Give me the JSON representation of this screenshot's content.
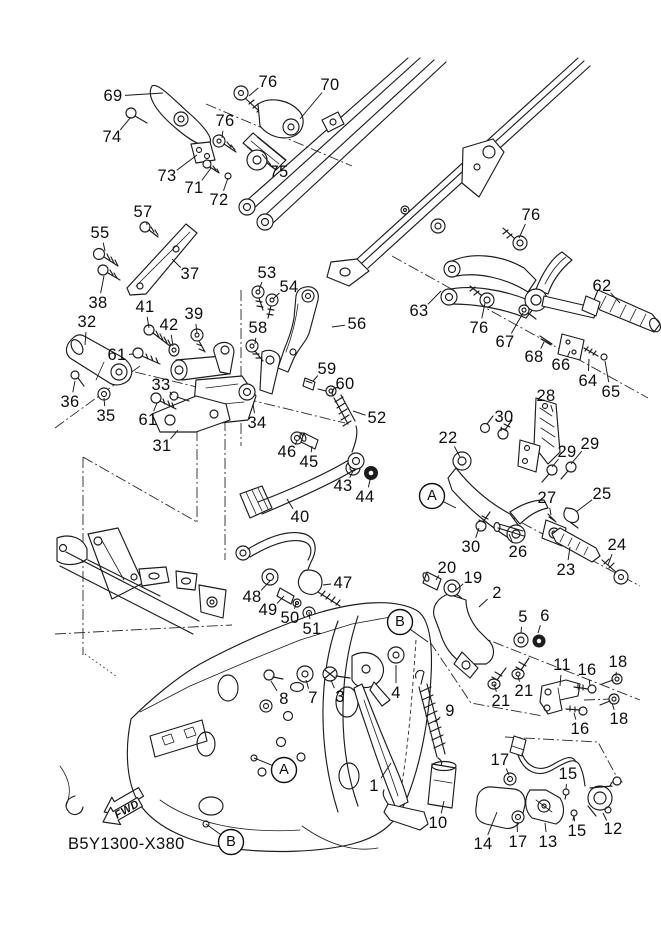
{
  "meta": {
    "drawing_code": "B5Y1300-X380",
    "fwd_label": "FWD",
    "background": "#ffffff",
    "line_color": "#1c1c1c",
    "description": "Exploded parts diagram - stand / footrest"
  },
  "callouts": [
    {
      "n": "69",
      "x": 113,
      "y": 96,
      "tx": 163,
      "ty": 93
    },
    {
      "n": "76",
      "x": 268,
      "y": 82,
      "tx": 249,
      "ty": 96
    },
    {
      "n": "70",
      "x": 330,
      "y": 85,
      "tx": 300,
      "ty": 119
    },
    {
      "n": "74",
      "x": 112,
      "y": 137,
      "tx": 131,
      "ty": 117
    },
    {
      "n": "76",
      "x": 225,
      "y": 121,
      "tx": 222,
      "ty": 138
    },
    {
      "n": "73",
      "x": 167,
      "y": 176,
      "tx": 197,
      "ty": 155
    },
    {
      "n": "71",
      "x": 194,
      "y": 188,
      "tx": 211,
      "ty": 168
    },
    {
      "n": "72",
      "x": 219,
      "y": 200,
      "tx": 228,
      "ty": 178
    },
    {
      "n": "75",
      "x": 279,
      "y": 172,
      "tx": 262,
      "ty": 154
    },
    {
      "n": "76",
      "x": 531,
      "y": 215,
      "tx": 519,
      "ty": 238
    },
    {
      "n": "57",
      "x": 143,
      "y": 212,
      "tx": 147,
      "ty": 225
    },
    {
      "n": "55",
      "x": 100,
      "y": 233,
      "tx": 105,
      "ty": 251
    },
    {
      "n": "38",
      "x": 98,
      "y": 303,
      "tx": 104,
      "ty": 276
    },
    {
      "n": "37",
      "x": 190,
      "y": 274,
      "tx": 172,
      "ty": 259
    },
    {
      "n": "53",
      "x": 267,
      "y": 273,
      "tx": 259,
      "ty": 290
    },
    {
      "n": "54",
      "x": 289,
      "y": 287,
      "tx": 273,
      "ty": 299
    },
    {
      "n": "62",
      "x": 602,
      "y": 286,
      "tx": 620,
      "ty": 303
    },
    {
      "n": "63",
      "x": 419,
      "y": 311,
      "tx": 441,
      "ty": 291
    },
    {
      "n": "32",
      "x": 87,
      "y": 322,
      "tx": 85,
      "ty": 345
    },
    {
      "n": "41",
      "x": 145,
      "y": 307,
      "tx": 149,
      "ty": 328
    },
    {
      "n": "42",
      "x": 169,
      "y": 325,
      "tx": 173,
      "ty": 346
    },
    {
      "n": "39",
      "x": 194,
      "y": 314,
      "tx": 197,
      "ty": 333
    },
    {
      "n": "58",
      "x": 258,
      "y": 328,
      "tx": 255,
      "ty": 344
    },
    {
      "n": "56",
      "x": 357,
      "y": 324,
      "tx": 332,
      "ty": 327
    },
    {
      "n": "76",
      "x": 479,
      "y": 328,
      "tx": 485,
      "ty": 303
    },
    {
      "n": "67",
      "x": 505,
      "y": 342,
      "tx": 523,
      "ty": 313
    },
    {
      "n": "68",
      "x": 534,
      "y": 357,
      "tx": 544,
      "ty": 342
    },
    {
      "n": "66",
      "x": 561,
      "y": 365,
      "tx": 570,
      "ty": 351
    },
    {
      "n": "61",
      "x": 117,
      "y": 355,
      "tx": 133,
      "ty": 354
    },
    {
      "n": "59",
      "x": 327,
      "y": 369,
      "tx": 313,
      "ty": 381
    },
    {
      "n": "64",
      "x": 588,
      "y": 381,
      "tx": 589,
      "ty": 359
    },
    {
      "n": "60",
      "x": 345,
      "y": 384,
      "tx": 333,
      "ty": 390
    },
    {
      "n": "65",
      "x": 611,
      "y": 392,
      "tx": 605,
      "ty": 361
    },
    {
      "n": "36",
      "x": 70,
      "y": 402,
      "tx": 75,
      "ty": 381
    },
    {
      "n": "33",
      "x": 161,
      "y": 385,
      "tx": 172,
      "ty": 395
    },
    {
      "n": "35",
      "x": 106,
      "y": 416,
      "tx": 104,
      "ty": 398
    },
    {
      "n": "61",
      "x": 148,
      "y": 420,
      "tx": 157,
      "ty": 403
    },
    {
      "n": "34",
      "x": 257,
      "y": 423,
      "tx": 253,
      "ty": 404
    },
    {
      "n": "52",
      "x": 377,
      "y": 418,
      "tx": 353,
      "ty": 411
    },
    {
      "n": "28",
      "x": 546,
      "y": 396,
      "tx": 553,
      "ty": 412
    },
    {
      "n": "30",
      "x": 504,
      "y": 417,
      "tx": 501,
      "ty": 431
    },
    {
      "n": "22",
      "x": 448,
      "y": 438,
      "tx": 460,
      "ty": 457
    },
    {
      "n": "29",
      "x": 567,
      "y": 452,
      "tx": 552,
      "ty": 467
    },
    {
      "n": "29",
      "x": 590,
      "y": 444,
      "tx": 571,
      "ty": 464
    },
    {
      "n": "31",
      "x": 162,
      "y": 446,
      "tx": 178,
      "ty": 430
    },
    {
      "n": "46",
      "x": 287,
      "y": 452,
      "tx": 297,
      "ty": 441
    },
    {
      "n": "45",
      "x": 309,
      "y": 462,
      "tx": 312,
      "ty": 446
    },
    {
      "n": "43",
      "x": 343,
      "y": 486,
      "tx": 353,
      "ty": 471
    },
    {
      "n": "44",
      "x": 365,
      "y": 497,
      "tx": 371,
      "ty": 476
    },
    {
      "n": "27",
      "x": 547,
      "y": 498,
      "tx": 551,
      "ty": 515
    },
    {
      "n": "25",
      "x": 602,
      "y": 494,
      "tx": 576,
      "ty": 512
    },
    {
      "n": "40",
      "x": 300,
      "y": 517,
      "tx": 287,
      "ty": 499
    },
    {
      "n": "26",
      "x": 518,
      "y": 552,
      "tx": 509,
      "ty": 534
    },
    {
      "n": "30",
      "x": 471,
      "y": 547,
      "tx": 479,
      "ty": 528
    },
    {
      "n": "23",
      "x": 566,
      "y": 570,
      "tx": 570,
      "ty": 547
    },
    {
      "n": "24",
      "x": 617,
      "y": 545,
      "tx": 608,
      "ty": 565
    },
    {
      "n": "20",
      "x": 447,
      "y": 568,
      "tx": 436,
      "ty": 580
    },
    {
      "n": "19",
      "x": 473,
      "y": 578,
      "tx": 456,
      "ty": 590
    },
    {
      "n": "47",
      "x": 343,
      "y": 583,
      "tx": 323,
      "ty": 585
    },
    {
      "n": "2",
      "x": 497,
      "y": 593,
      "tx": 479,
      "ty": 607
    },
    {
      "n": "48",
      "x": 252,
      "y": 597,
      "tx": 270,
      "ty": 581
    },
    {
      "n": "49",
      "x": 268,
      "y": 610,
      "tx": 284,
      "ty": 596
    },
    {
      "n": "50",
      "x": 290,
      "y": 618,
      "tx": 296,
      "ty": 603
    },
    {
      "n": "5",
      "x": 523,
      "y": 617,
      "tx": 521,
      "ty": 633
    },
    {
      "n": "6",
      "x": 545,
      "y": 616,
      "tx": 538,
      "ty": 633
    },
    {
      "n": "51",
      "x": 312,
      "y": 629,
      "tx": 309,
      "ty": 612
    },
    {
      "n": "18",
      "x": 618,
      "y": 662,
      "tx": 616,
      "ty": 676
    },
    {
      "n": "11",
      "x": 562,
      "y": 665,
      "tx": 560,
      "ty": 686
    },
    {
      "n": "16",
      "x": 587,
      "y": 670,
      "tx": 590,
      "ty": 686
    },
    {
      "n": "21",
      "x": 501,
      "y": 701,
      "tx": 494,
      "ty": 684
    },
    {
      "n": "21",
      "x": 524,
      "y": 691,
      "tx": 518,
      "ty": 676
    },
    {
      "n": "4",
      "x": 396,
      "y": 693,
      "tx": 396,
      "ty": 665
    },
    {
      "n": "8",
      "x": 284,
      "y": 699,
      "tx": 271,
      "ty": 681
    },
    {
      "n": "7",
      "x": 313,
      "y": 698,
      "tx": 306,
      "ty": 680
    },
    {
      "n": "3",
      "x": 340,
      "y": 697,
      "tx": 331,
      "ty": 680
    },
    {
      "n": "9",
      "x": 450,
      "y": 711,
      "tx": 435,
      "ty": 722
    },
    {
      "n": "16",
      "x": 580,
      "y": 729,
      "tx": 574,
      "ty": 713
    },
    {
      "n": "18",
      "x": 619,
      "y": 719,
      "tx": 612,
      "ty": 703
    },
    {
      "n": "17",
      "x": 500,
      "y": 760,
      "tx": 509,
      "ty": 775
    },
    {
      "n": "15",
      "x": 568,
      "y": 774,
      "tx": 566,
      "ty": 789
    },
    {
      "n": "1",
      "x": 374,
      "y": 786,
      "tx": 391,
      "ty": 763
    },
    {
      "n": "10",
      "x": 438,
      "y": 823,
      "tx": 444,
      "ty": 801
    },
    {
      "n": "12",
      "x": 613,
      "y": 829,
      "tx": 603,
      "ty": 813
    },
    {
      "n": "15",
      "x": 577,
      "y": 831,
      "tx": 574,
      "ty": 816
    },
    {
      "n": "13",
      "x": 548,
      "y": 842,
      "tx": 545,
      "ty": 823
    },
    {
      "n": "17",
      "x": 518,
      "y": 842,
      "tx": 517,
      "ty": 822
    },
    {
      "n": "14",
      "x": 483,
      "y": 844,
      "tx": 497,
      "ty": 812
    }
  ],
  "ref_markers": [
    {
      "letter": "A",
      "x": 432,
      "y": 496,
      "tx": 456,
      "ty": 508
    },
    {
      "letter": "B",
      "x": 400,
      "y": 622,
      "tx": 428,
      "ty": 642
    },
    {
      "letter": "A",
      "x": 284,
      "y": 770,
      "tx": 254,
      "ty": 758
    },
    {
      "letter": "B",
      "x": 231,
      "y": 842,
      "tx": 206,
      "ty": 824
    }
  ]
}
